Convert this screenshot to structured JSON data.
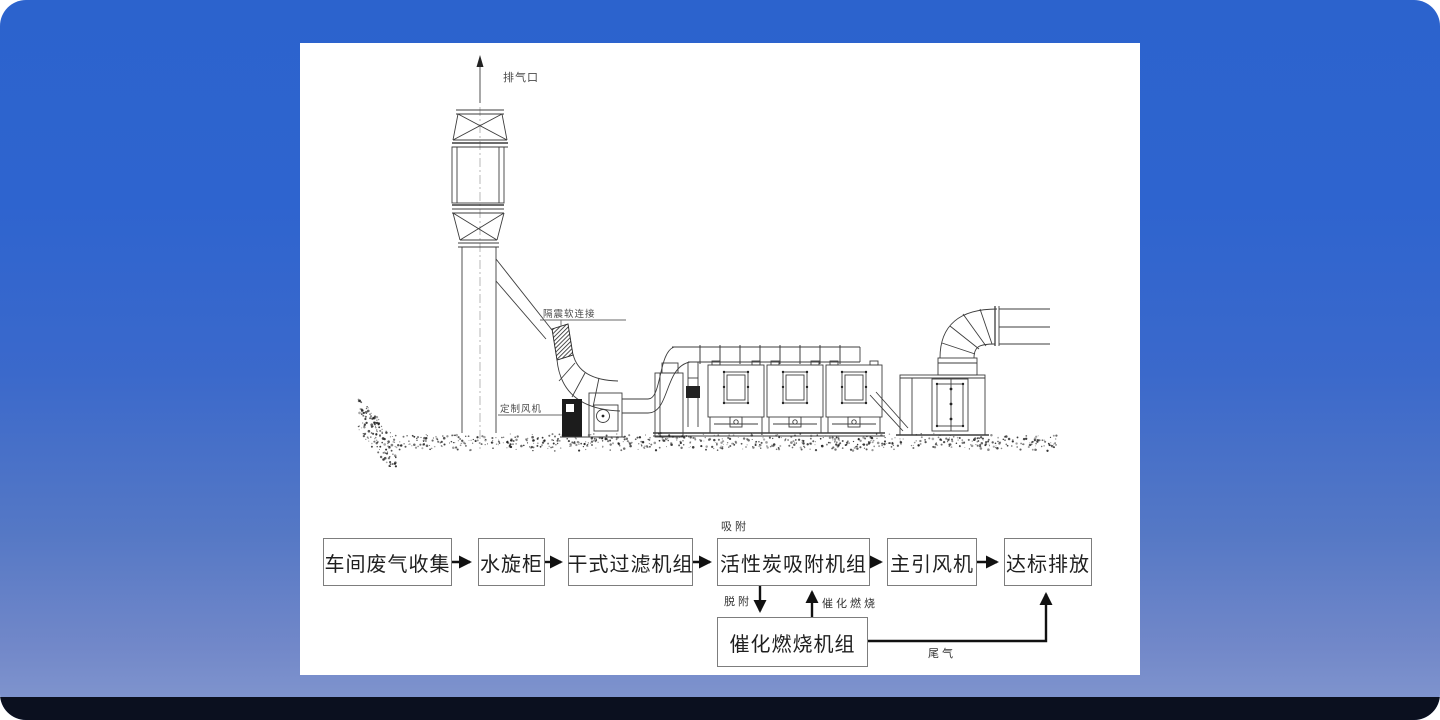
{
  "card": {
    "background_top": "#2c63cd",
    "background_bottom": "#7e93cd",
    "footer_bar_color": "#0b101f",
    "panel_background": "#ffffff"
  },
  "diagram": {
    "labels": {
      "exhaust_outlet": "排气口",
      "flex_connector": "隔震软连接",
      "custom_fan": "定制风机"
    }
  },
  "flowchart": {
    "boxes": [
      {
        "label": "车间废气收集"
      },
      {
        "label": "水旋柜"
      },
      {
        "label": "干式过滤机组"
      },
      {
        "label": "活性炭吸附机组"
      },
      {
        "label": "主引风机"
      },
      {
        "label": "达标排放"
      },
      {
        "label": "催化燃烧机组"
      }
    ],
    "edge_labels": {
      "adsorption": "吸附",
      "desorption": "脱附",
      "catalytic_combustion": "催化燃烧",
      "tail_gas": "尾气"
    }
  }
}
